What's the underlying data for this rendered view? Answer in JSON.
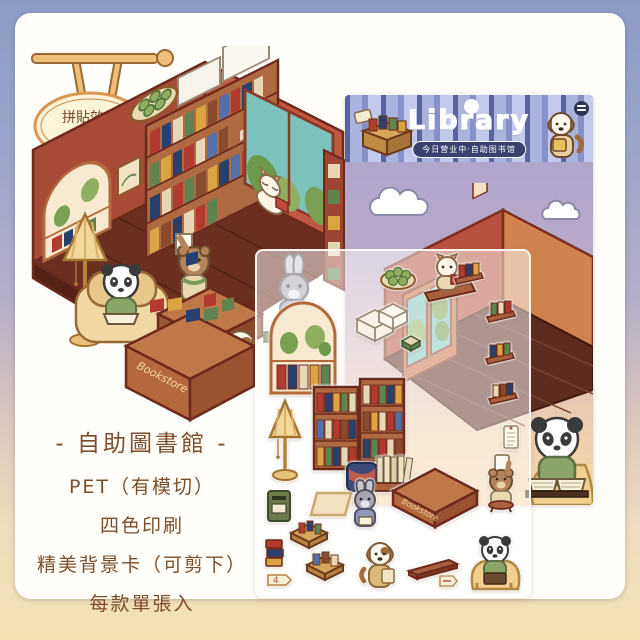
{
  "reference_badge": {
    "line1": "拼貼效果",
    "line2": "參考圖"
  },
  "packaging": {
    "brand_title": "Library",
    "status_pill": "今日营业中·自助图书馆"
  },
  "scene": {
    "counter_label": "Bookstore"
  },
  "stickers": {
    "price_tag": "4"
  },
  "product_info": {
    "title": "- 自助圖書館 -",
    "features": [
      "PET（有模切）",
      "四色印刷",
      "精美背景卡（可剪下）",
      "每款單張入"
    ]
  },
  "colors": {
    "border_top": "#8d9cc6",
    "border_bottom": "#f3e3b3",
    "card": "#fffefb",
    "wall_maroon": "#a84b36",
    "wall_brick": "#bf5a40",
    "floor_brown": "#63291d",
    "header_navy": "#3a4170",
    "stripe_light": "#c3c9ec",
    "stripe_mid": "#8791c7",
    "sky_lavender": "#a9a2cb",
    "ground_peach": "#f6d7a8",
    "text_brown": "#7d4e2a"
  }
}
